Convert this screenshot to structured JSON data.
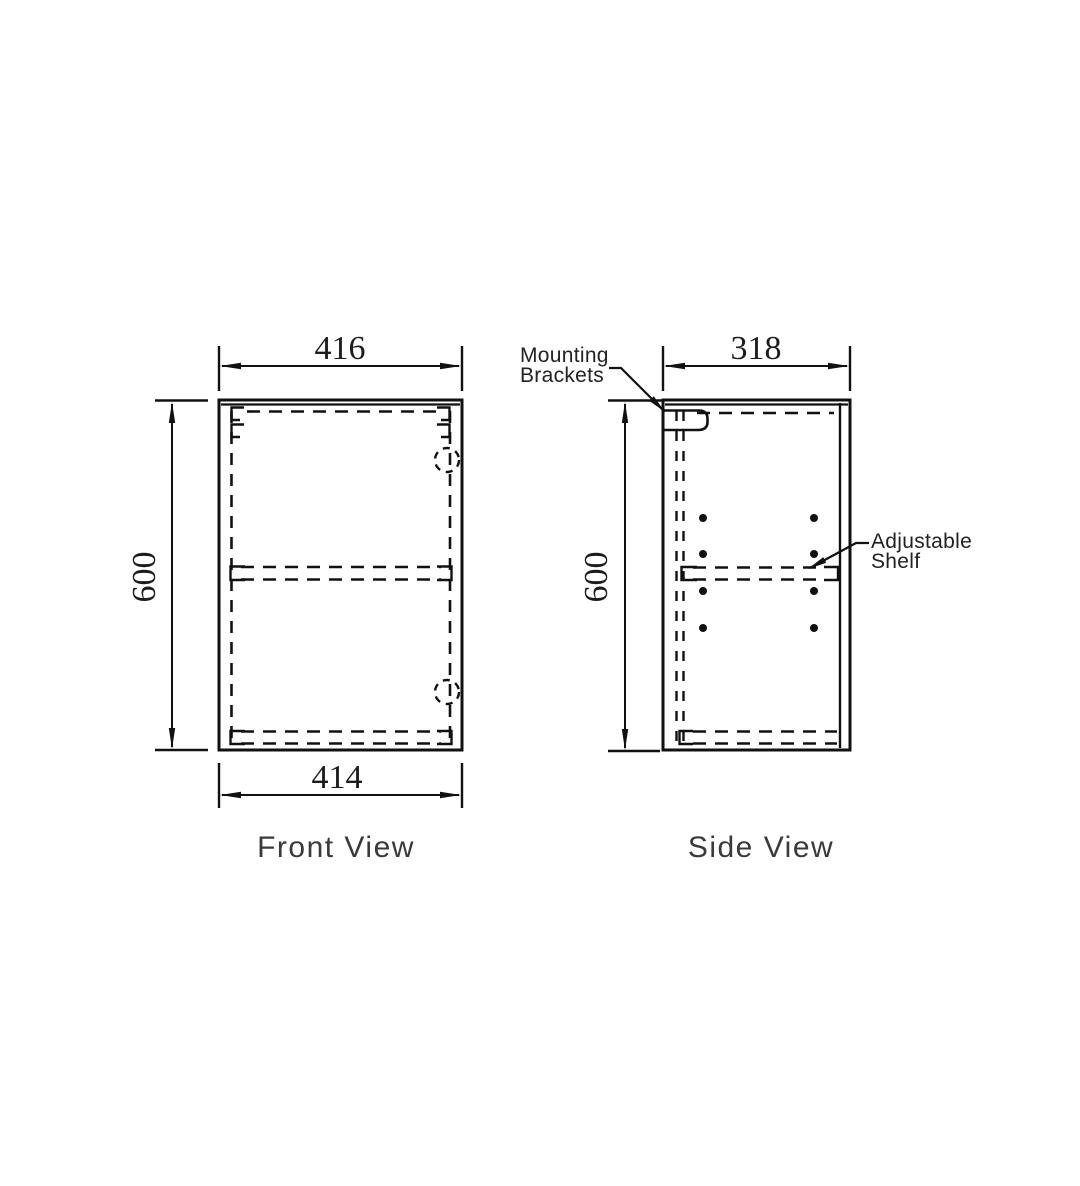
{
  "drawing": {
    "front_view": {
      "caption": "Front View",
      "dim_top_width": "416",
      "dim_bottom_width": "414",
      "dim_height": "600"
    },
    "side_view": {
      "caption": "Side View",
      "dim_depth": "318",
      "dim_height": "600"
    },
    "labels": {
      "mounting_brackets": {
        "line1": "Mounting",
        "line2": "Brackets"
      },
      "adjustable_shelf": {
        "line1": "Adjustable",
        "line2": "Shelf"
      }
    },
    "colors": {
      "line": "#111111",
      "dimension_text": "#1c1c1c",
      "caption_text": "#3a3a3a",
      "background": "#ffffff"
    }
  }
}
